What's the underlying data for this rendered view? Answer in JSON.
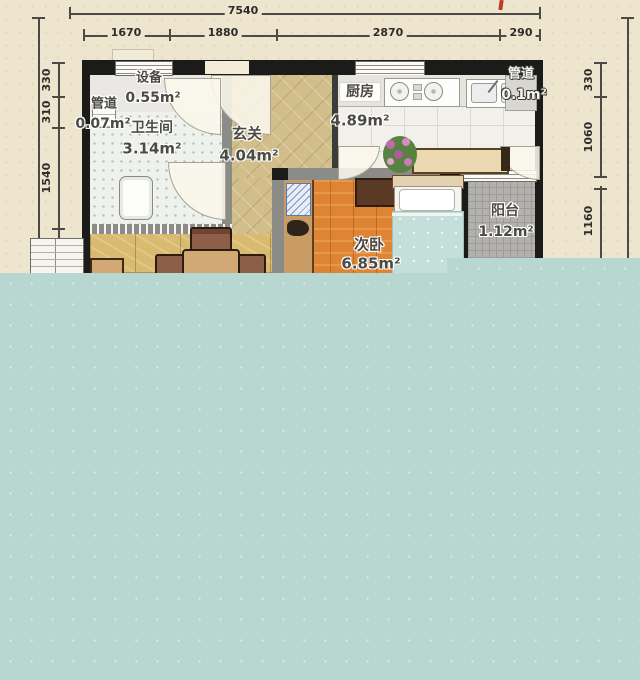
{
  "scene": "apartment-floor-plan",
  "dimensions": {
    "top_total": "7540",
    "top_segments": [
      "1670",
      "1880",
      "2870",
      "290"
    ],
    "left_segments": [
      "330",
      "310",
      "1540"
    ],
    "right_segments": [
      "330",
      "1060",
      "1160"
    ]
  },
  "rooms": {
    "equipment": {
      "name": "设备",
      "area": "0.55m²"
    },
    "pipe_left": {
      "name": "管道",
      "area": "0.07m²"
    },
    "bathroom": {
      "name": "卫生间",
      "area": "3.14m²"
    },
    "entry": {
      "name": "玄关",
      "area": "4.04m²"
    },
    "kitchen": {
      "name": "厨房",
      "area": "4.89m²"
    },
    "pipe_right": {
      "name": "管道",
      "area": "0.1m²"
    },
    "bedroom": {
      "name": "次卧",
      "area": "6.85m²"
    },
    "balcony": {
      "name": "阳台",
      "area": "1.12m²"
    }
  },
  "colors": {
    "paper": "#eee5cf",
    "teal_overlay": "#b9d7d1",
    "wall": "#1b1b19",
    "entry_floor": "#d2be8b",
    "wood_floor": "#df8433",
    "marble_floor": "#d8bb71",
    "balcony_floor": "#b3b1ad",
    "bed_blanket": "#c4dfd9",
    "red_mark": "#c0392b"
  }
}
